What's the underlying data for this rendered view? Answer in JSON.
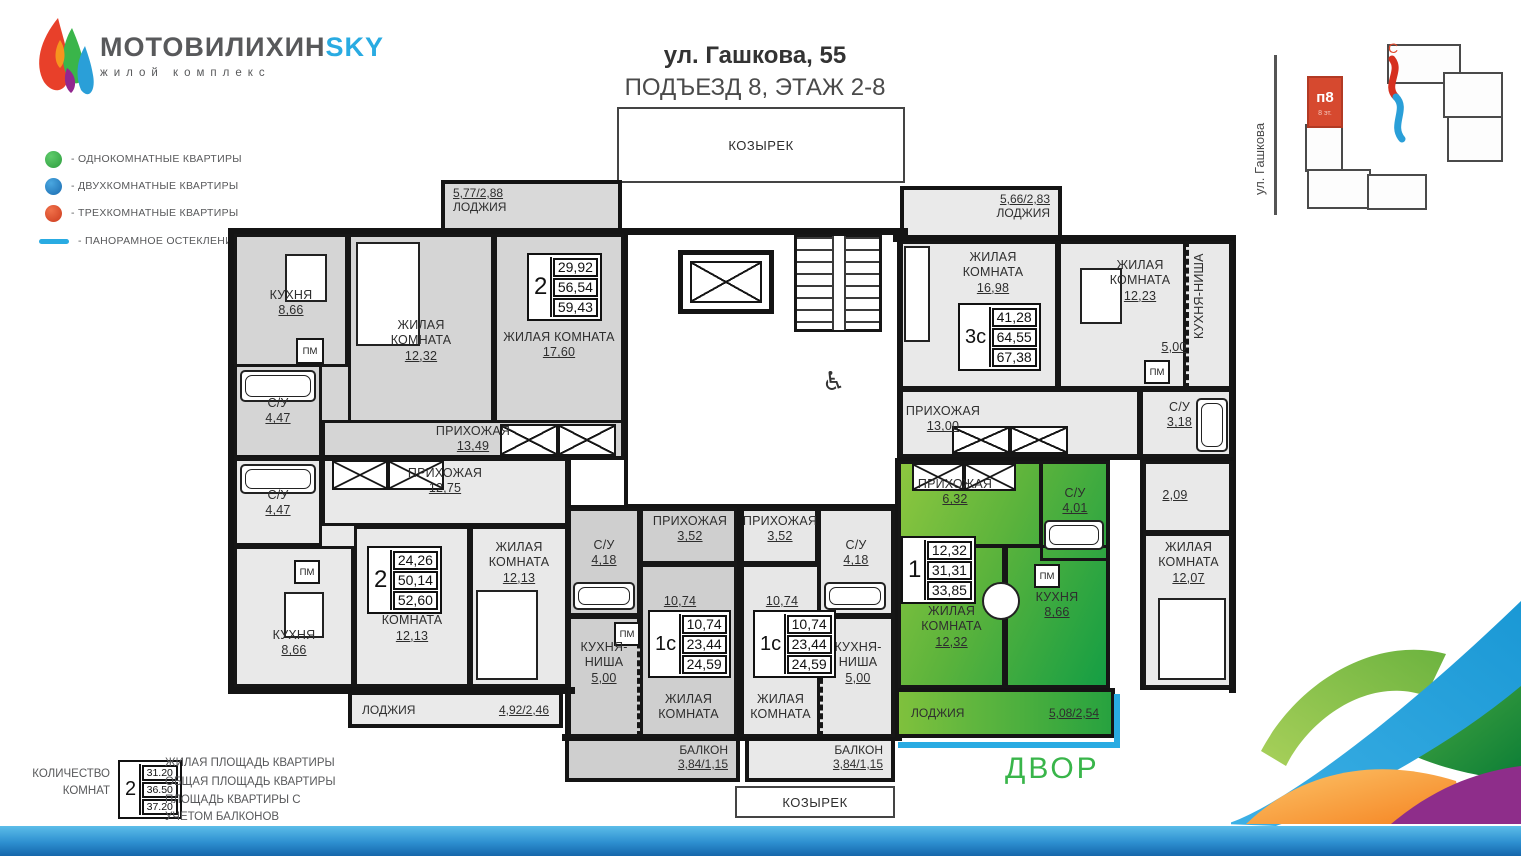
{
  "logo": {
    "title_main": "МОТОВИЛИХИН",
    "title_accent": "SKY",
    "subtitle": "жилой комплекс"
  },
  "legend": {
    "one_room": "- ОДНОКОМНАТНЫЕ КВАРТИРЫ",
    "two_room": "- ДВУХКОМНАТНЫЕ КВАРТИРЫ",
    "three_room": "- ТРЕХКОМНАТНЫЕ КВАРТИРЫ",
    "panoramic": "- ПАНОРАМНОЕ ОСТЕКЛЕНИЕ",
    "colors": {
      "one": "#39b54a",
      "two": "#2385c6",
      "three": "#e0492c",
      "line": "#29abe2"
    }
  },
  "header": {
    "address": "ул. Гашкова, 55",
    "subtitle": "ПОДЪЕЗД 8, ЭТАЖ 2-8"
  },
  "site_plan": {
    "street": "ул. Гашкова",
    "building": "п8",
    "floors": "8 эт.",
    "compass": "С"
  },
  "courtyard_label": "ДВОР",
  "plan": {
    "canopy": "КОЗЫРЕК",
    "pm": "ПМ",
    "loggia_tl": {
      "area": "5,77/2,88",
      "name": "ЛОДЖИЯ"
    },
    "loggia_tr": {
      "area": "5,66/2,83",
      "name": "ЛОДЖИЯ"
    },
    "loggia_bl": {
      "name": "ЛОДЖИЯ",
      "area": "4,92/2,46"
    },
    "loggia_green": {
      "name": "ЛОДЖИЯ",
      "area": "5,08/2,54"
    },
    "balcony_l": {
      "name": "БАЛКОН",
      "area": "3,84/1,15"
    },
    "balcony_r": {
      "name": "БАЛКОН",
      "area": "3,84/1,15"
    },
    "apartments": {
      "a2_top": {
        "type": "2",
        "stats": [
          "29,92",
          "56,54",
          "59,43"
        ],
        "kitchen": {
          "name": "КУХНЯ",
          "area": "8,66"
        },
        "living1": {
          "name": "ЖИЛАЯ КОМНАТА",
          "area": "12,32"
        },
        "living2": {
          "name": "ЖИЛАЯ КОМНАТА",
          "area": "17,60"
        },
        "bath": {
          "name": "С/У",
          "area": "4,47"
        },
        "hall": {
          "name": "ПРИХОЖАЯ",
          "area": "13,49"
        }
      },
      "a2_bot": {
        "type": "2",
        "stats": [
          "24,26",
          "50,14",
          "52,60"
        ],
        "bath": {
          "name": "С/У",
          "area": "4,47"
        },
        "hall": {
          "name": "ПРИХОЖАЯ",
          "area": "12,75"
        },
        "living1": {
          "name": "ЖИЛАЯ КОМНАТА",
          "area": "12,13"
        },
        "living2": {
          "name": "ЖИЛАЯ КОМНАТА",
          "area": "12,13"
        },
        "kitchen": {
          "name": "КУХНЯ",
          "area": "8,66"
        }
      },
      "s1_left": {
        "type": "1с",
        "stats": [
          "10,74",
          "23,44",
          "24,59"
        ],
        "hall": {
          "name": "ПРИХОЖАЯ",
          "area": "3,52"
        },
        "bath": {
          "name": "С/У",
          "area": "4,18"
        },
        "main_area": "10,74",
        "niche": {
          "name": "КУХНЯ-НИША",
          "area": "5,00"
        },
        "living": {
          "name": "ЖИЛАЯ КОМНАТА"
        }
      },
      "s1_right": {
        "type": "1с",
        "stats": [
          "10,74",
          "23,44",
          "24,59"
        ],
        "hall": {
          "name": "ПРИХОЖАЯ",
          "area": "3,52"
        },
        "bath": {
          "name": "С/У",
          "area": "4,18"
        },
        "main_area": "10,74",
        "niche": {
          "name": "КУХНЯ-НИША",
          "area": "5,00"
        },
        "living": {
          "name": "ЖИЛАЯ КОМНАТА"
        }
      },
      "g1": {
        "type": "1",
        "stats": [
          "12,32",
          "31,31",
          "33,85"
        ],
        "hall": {
          "name": "ПРИХОЖАЯ",
          "area": "6,32"
        },
        "bath": {
          "name": "С/У",
          "area": "4,01"
        },
        "living": {
          "name": "ЖИЛАЯ КОМНАТА",
          "area": "12,32"
        },
        "kitchen": {
          "name": "КУХНЯ",
          "area": "8,66"
        }
      },
      "a3_top": {
        "type": "3с",
        "stats": [
          "41,28",
          "64,55",
          "67,38"
        ],
        "living1": {
          "name": "ЖИЛАЯ КОМНАТА",
          "area": "16,98"
        },
        "living2": {
          "name": "ЖИЛАЯ КОМНАТА",
          "area": "12,23"
        },
        "niche": {
          "name": "КУХНЯ-НИША",
          "area": "5,00"
        },
        "hall": {
          "name": "ПРИХОЖАЯ",
          "area": "13,00"
        },
        "bath": {
          "name": "С/У",
          "area": "3,18"
        }
      },
      "right_col": {
        "wc_area": "2,09",
        "living": {
          "name": "ЖИЛАЯ КОМНАТА",
          "area": "12,07"
        }
      }
    }
  },
  "footer_legend": {
    "room_count_label": "КОЛИЧЕСТВО КОМНАТ",
    "sample": {
      "rooms": "2",
      "living": "31.20",
      "total": "36.50",
      "with_balcony": "37.20"
    },
    "line_living": "ЖИЛАЯ ПЛОЩАДЬ КВАРТИРЫ",
    "line_total": "ОБЩАЯ ПЛОЩАДЬ КВАРТИРЫ",
    "line_balcony": "ПЛОЩАДЬ КВАРТИРЫ С УЧЕТОМ БАЛКОНОВ"
  }
}
